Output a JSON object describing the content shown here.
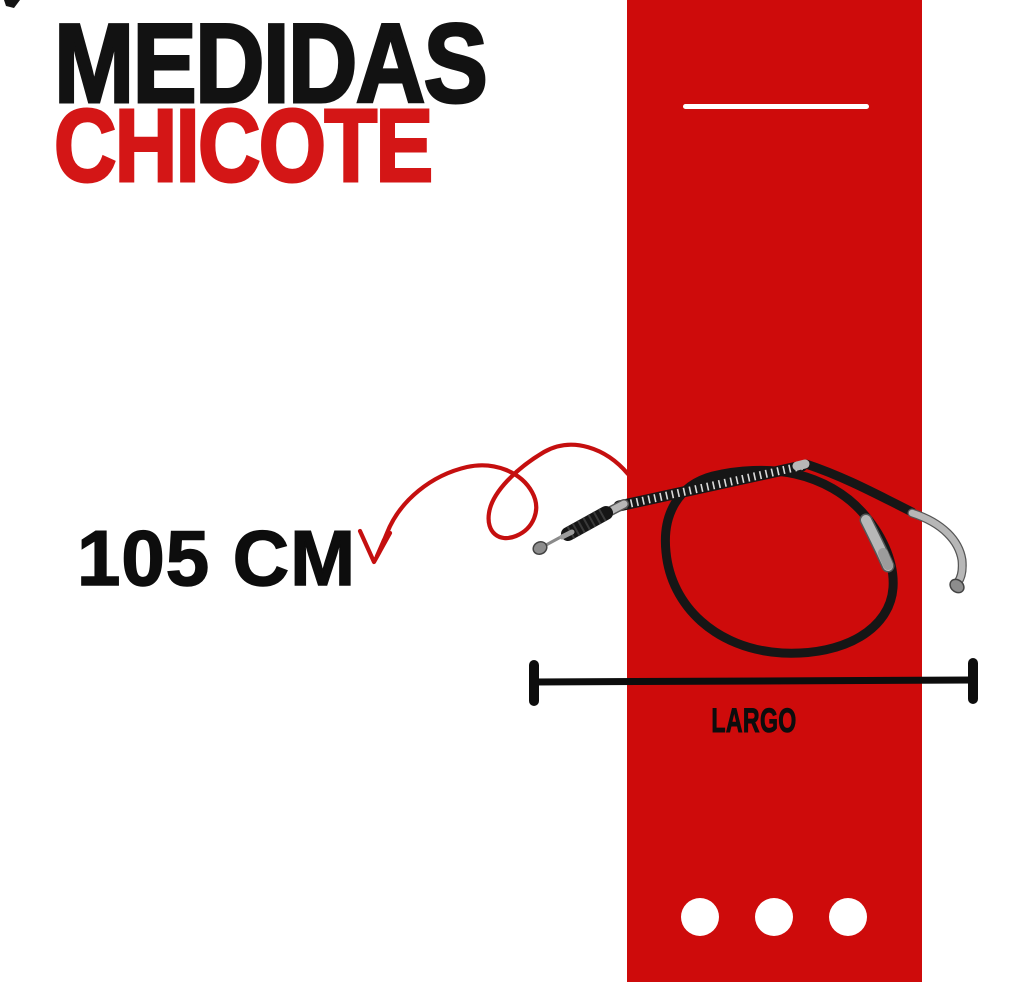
{
  "title": {
    "line1": "MEDIDAS",
    "line2": "CHICOTE"
  },
  "measurement": {
    "value": "105 CM"
  },
  "dimension": {
    "label": "LARGO"
  },
  "footer": {
    "dots_count": 3
  },
  "colors": {
    "background": "#ffffff",
    "band": "#ce0b0b",
    "title_primary": "#121212",
    "title_accent": "#d41616",
    "arrow": "#c50f0f",
    "ink": "#0d0d0d",
    "divider": "#ffffff",
    "dot": "#ffffff"
  },
  "icons": {
    "curved_arrow": "hand-drawn looping red arrow pointing at measurement text",
    "cable": "motorcycle clutch cable coiled in a loop with metal end fittings",
    "dimension_line": "horizontal length gauge line with end bars",
    "pagination_dots": "three white circles"
  }
}
